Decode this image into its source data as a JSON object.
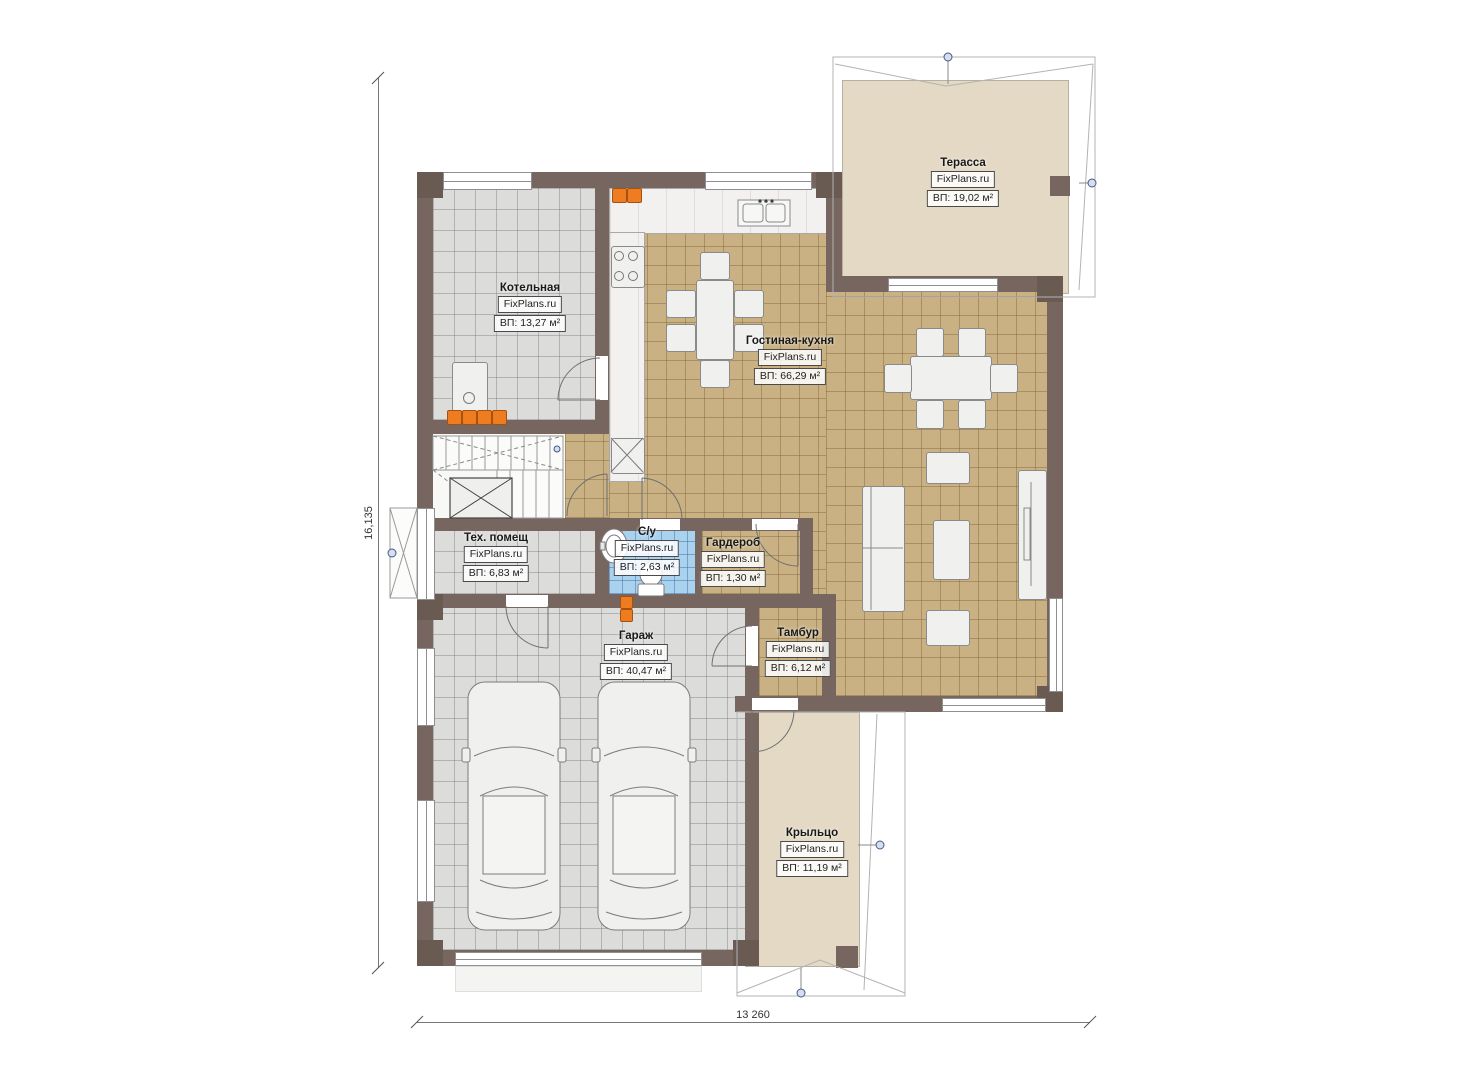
{
  "title": "Floor plan — first floor",
  "brand": "FixPlans.ru",
  "rooms": [
    {
      "id": "terrace",
      "name": "Терасса",
      "watermark": "FixPlans.ru",
      "area": "ВП: 19,02 м²"
    },
    {
      "id": "boiler",
      "name": "Котельная",
      "watermark": "FixPlans.ru",
      "area": "ВП: 13,27 м²"
    },
    {
      "id": "living",
      "name": "Гостиная-кухня",
      "watermark": "FixPlans.ru",
      "area": "ВП: 66,29 м²"
    },
    {
      "id": "tech",
      "name": "Тех. помещ",
      "watermark": "FixPlans.ru",
      "area": "ВП: 6,83 м²"
    },
    {
      "id": "bathroom",
      "name": "С/у",
      "watermark": "FixPlans.ru",
      "area": "ВП: 2,63 м²"
    },
    {
      "id": "wardrobe",
      "name": "Гардероб",
      "watermark": "FixPlans.ru",
      "area": "ВП: 1,30 м²"
    },
    {
      "id": "garage",
      "name": "Гараж",
      "watermark": "FixPlans.ru",
      "area": "ВП: 40,47 м²"
    },
    {
      "id": "vestibule",
      "name": "Тамбур",
      "watermark": "FixPlans.ru",
      "area": "ВП: 6,12 м²"
    },
    {
      "id": "porch",
      "name": "Крыльцо",
      "watermark": "FixPlans.ru",
      "area": "ВП: 11,19 м²"
    }
  ],
  "dimensions": {
    "height_label": "16,135",
    "width_label": "13 260"
  },
  "colors": {
    "wall": "#76665f",
    "floor_tan": "#c9b184",
    "floor_gray": "#dcdcda",
    "floor_blue": "#a9d2ee",
    "deck": "#e4d9c5",
    "radiator": "#ee7d22",
    "marker": "#42598f"
  }
}
